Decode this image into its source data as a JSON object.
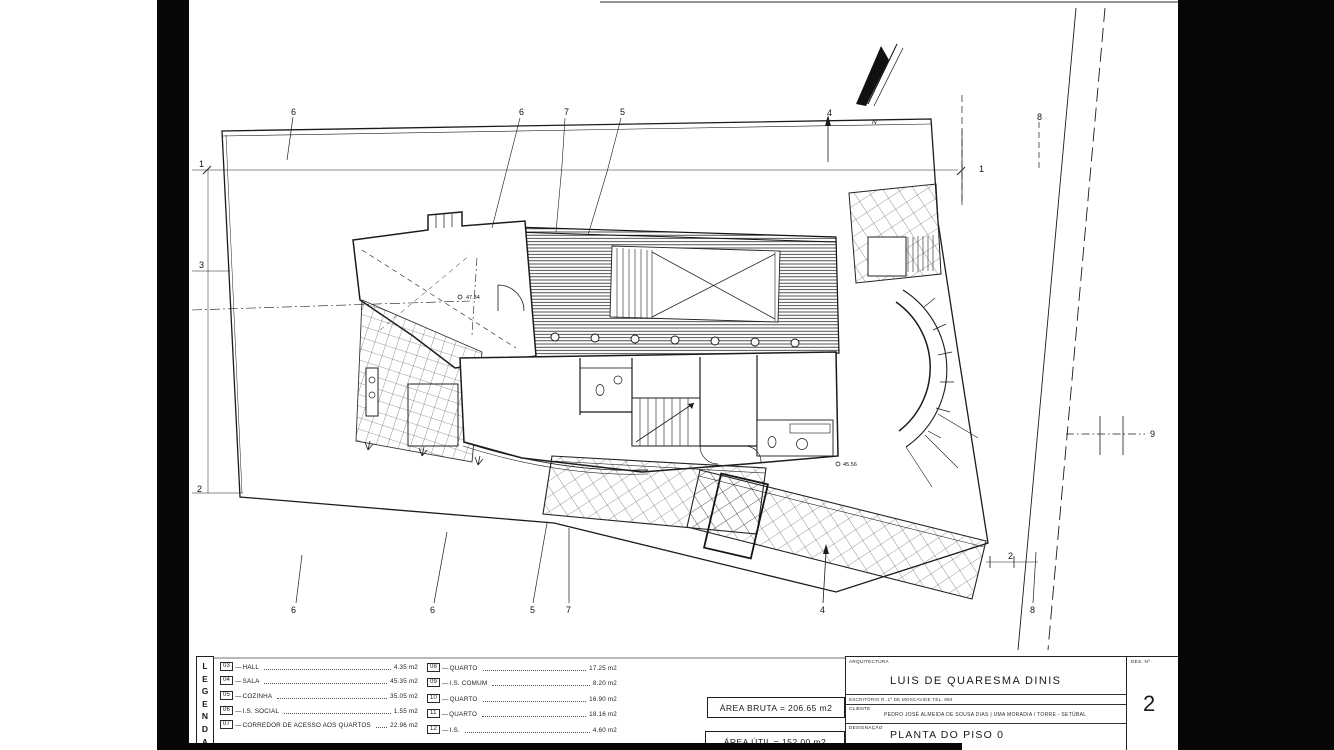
{
  "colors": {
    "ink": "#1b1b1b",
    "scan_black": "#070707",
    "paper": "#ffffff"
  },
  "legend": {
    "title": "LEGENDA",
    "col1": [
      {
        "code": "03",
        "name": "HALL",
        "area": "4.35 m2"
      },
      {
        "code": "04",
        "name": "SALA",
        "area": "45.35 m2"
      },
      {
        "code": "05",
        "name": "COZINHA",
        "area": "35.05 m2"
      },
      {
        "code": "06",
        "name": "I.S. SOCIAL",
        "area": "1.55 m2"
      },
      {
        "code": "07",
        "name": "CORREDOR DE ACESSO AOS QUARTOS",
        "area": "22.96 m2"
      }
    ],
    "col2": [
      {
        "code": "08",
        "name": "QUARTO",
        "area": "17.25 m2"
      },
      {
        "code": "09",
        "name": "I.S. COMUM",
        "area": "8.20 m2"
      },
      {
        "code": "10",
        "name": "QUARTO",
        "area": "16.90 m2"
      },
      {
        "code": "11",
        "name": "QUARTO",
        "area": "18.16 m2"
      },
      {
        "code": "12",
        "name": "I.S.",
        "area": "4.60 m2"
      }
    ]
  },
  "areas": {
    "bruta": "ÁREA BRUTA = 206.65 m2",
    "util": "ÁREA ÚTIL = 152.00 m2"
  },
  "title_block": {
    "discipline_label": "ARQUITECTURA",
    "architect": "LUIS DE QUARESMA DINIS",
    "office_line": "ESCRITÓRIO   R. 1º DE MOSCAVIDE   TEL. 994",
    "client_label": "CLIENTE",
    "client_line": "PEDRO JOSÉ ALMEIDA DE SOUSA DIAS | UMA MORADIA / TORRE - SETÚBAL",
    "designation_label": "DESIGNAÇÃO",
    "designation": "PLANTA DO PISO 0",
    "sheet_label": "DES. Nº",
    "sheet_number": "2"
  },
  "plan": {
    "north_label": "N",
    "grid_marks_top": [
      "6",
      "6",
      "7",
      "5",
      "4",
      "8"
    ],
    "grid_marks_bottom": [
      "6",
      "6",
      "5",
      "7",
      "4",
      "8"
    ],
    "grid_marks_left": [
      "1",
      "3",
      "2"
    ],
    "grid_marks_right": [
      "1",
      "9",
      "2"
    ],
    "spot_levels": [
      "47.34",
      "45.56"
    ]
  }
}
